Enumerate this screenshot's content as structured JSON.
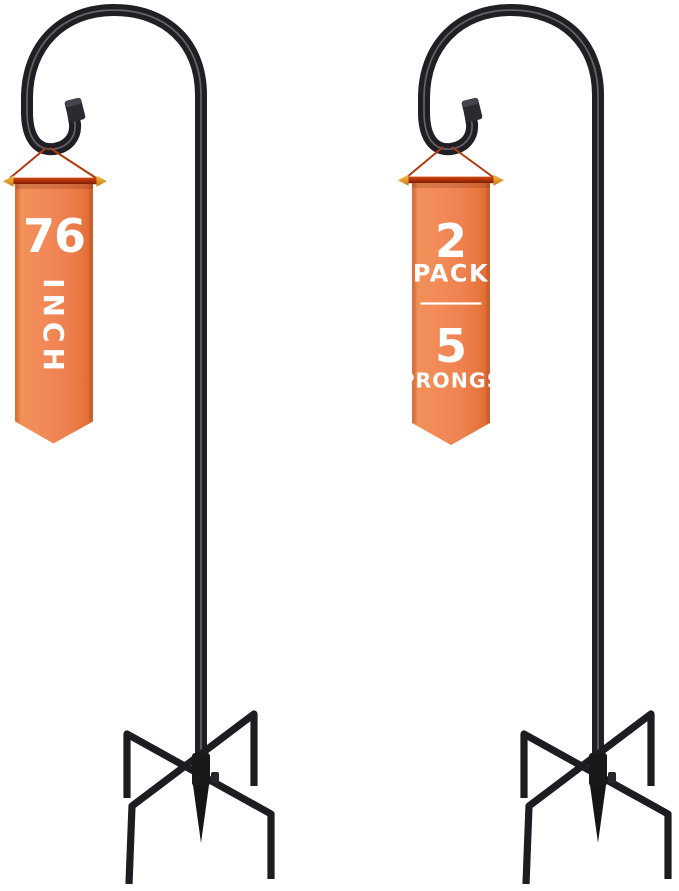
{
  "banners": {
    "left": {
      "size_value": "76",
      "size_unit": "INCH"
    },
    "right": {
      "pack_value": "2",
      "pack_label": "PACK",
      "prongs_value": "5",
      "prongs_label": "PRONGS"
    }
  },
  "icons": {
    "banner_hanger_left": "double-arrow-bar-icon",
    "banner_hanger_right": "double-arrow-bar-icon",
    "arrow_glyph": "↔"
  },
  "colors": {
    "background": "#FFFFFF",
    "metal_black": "#202024",
    "banner_orange": "#EF8250",
    "banner_orange_light": "#F29058",
    "banner_orange_dark": "#DD6830",
    "hanger_bar_red": "#AB2F08",
    "arrow_gold": "#E09A28",
    "string_red": "#B03A10",
    "text_white": "#FFFFFF"
  }
}
